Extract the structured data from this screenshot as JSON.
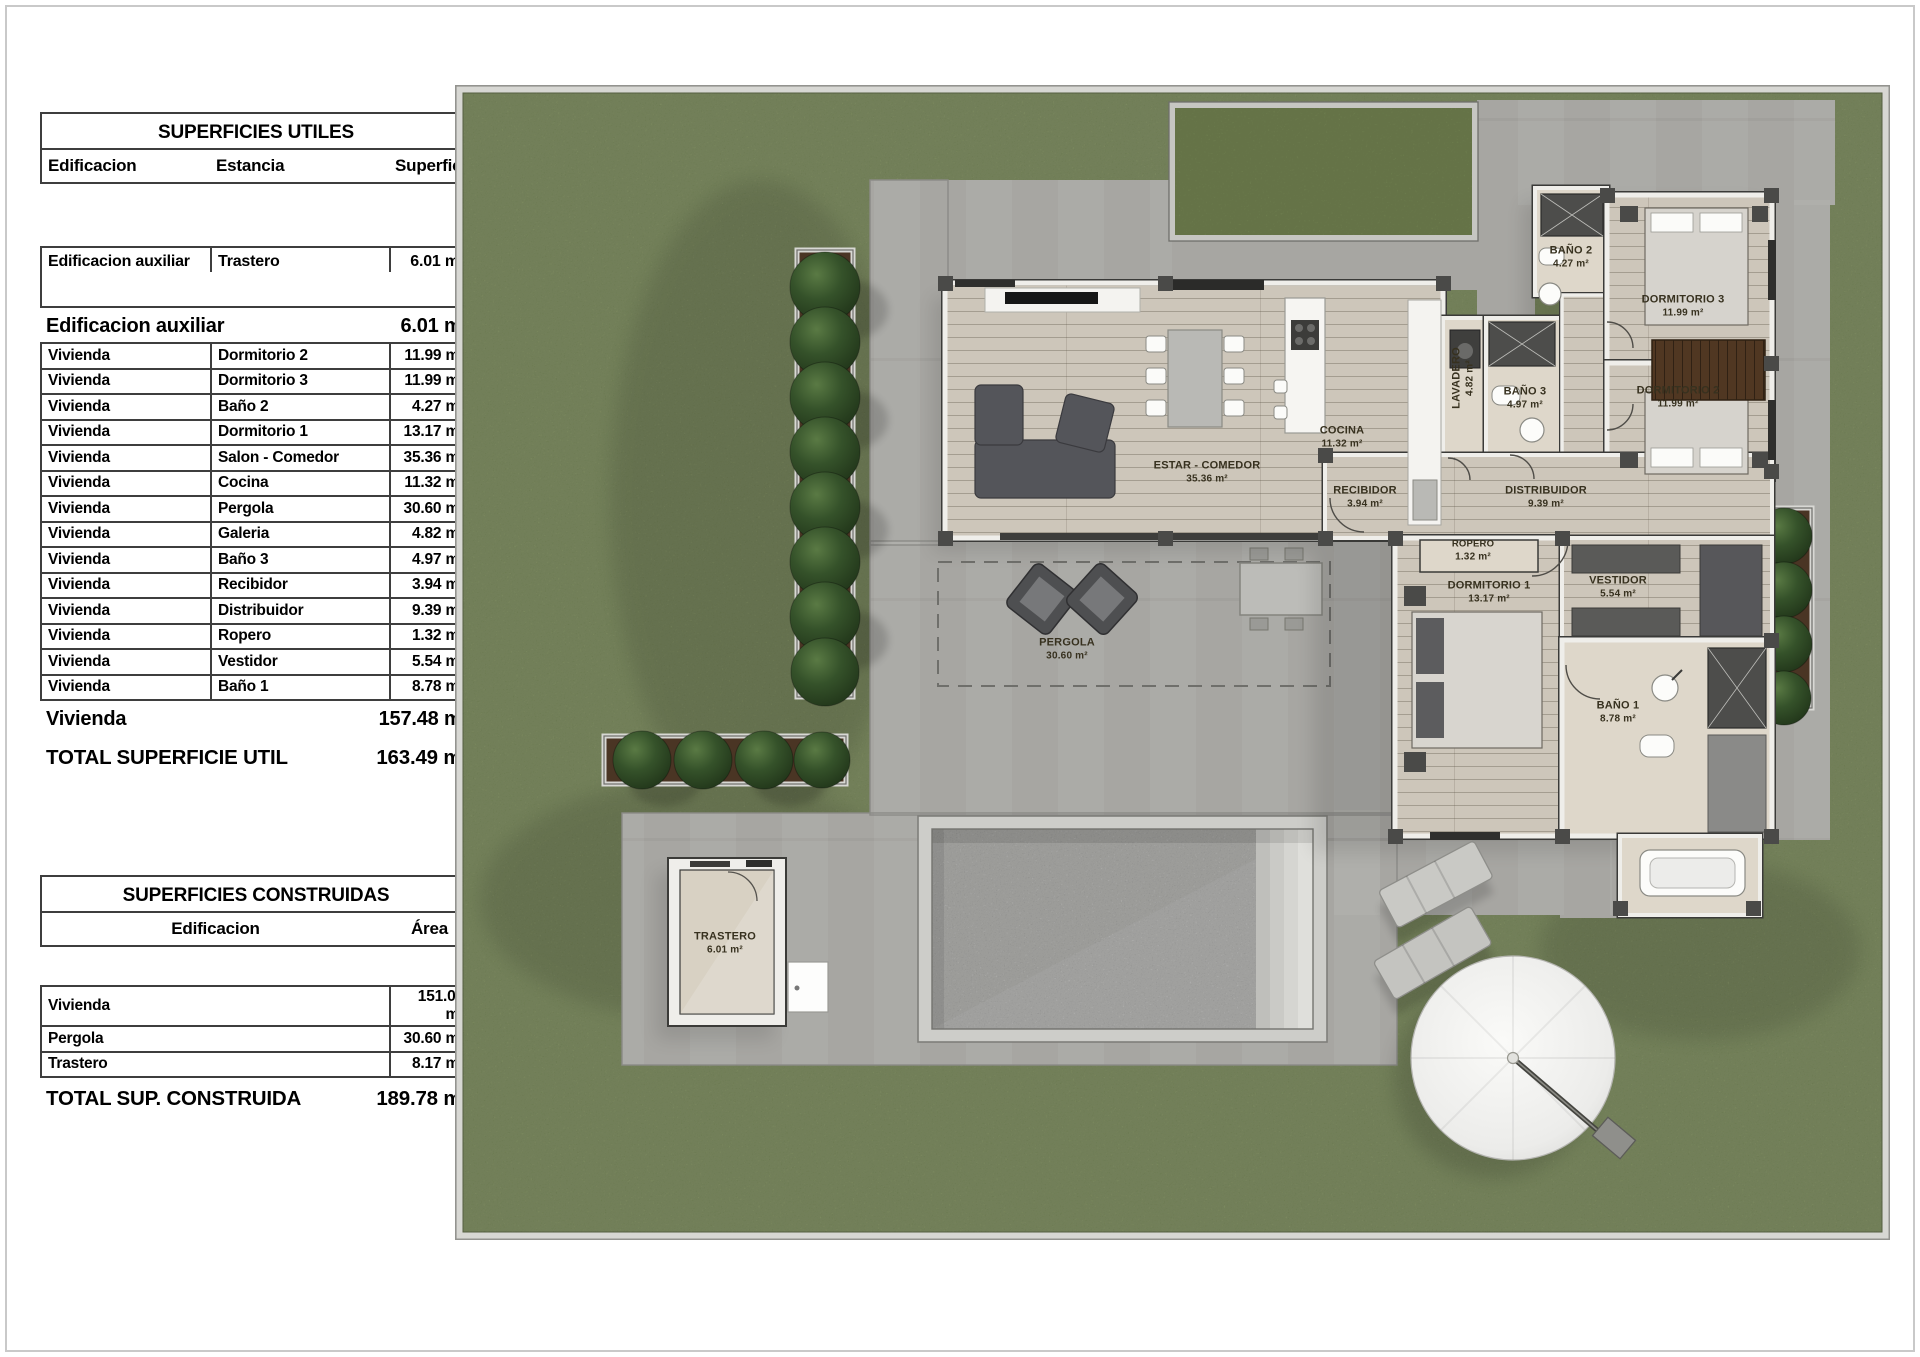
{
  "tables": {
    "superficies_utiles": {
      "title": "SUPERFICIES UTILES",
      "columns": [
        "Edificacion",
        "Estancia",
        "Superficie"
      ],
      "aux_row": {
        "edificacion": "Edificacion auxiliar",
        "estancia": "Trastero",
        "superficie": "6.01 m²"
      },
      "aux_total": {
        "label": "Edificacion auxiliar",
        "value": "6.01 m²"
      },
      "rows": [
        {
          "edificacion": "Vivienda",
          "estancia": "Dormitorio 2",
          "superficie": "11.99 m²"
        },
        {
          "edificacion": "Vivienda",
          "estancia": "Dormitorio 3",
          "superficie": "11.99 m²"
        },
        {
          "edificacion": "Vivienda",
          "estancia": "Baño 2",
          "superficie": "4.27 m²"
        },
        {
          "edificacion": "Vivienda",
          "estancia": "Dormitorio 1",
          "superficie": "13.17 m²"
        },
        {
          "edificacion": "Vivienda",
          "estancia": "Salon - Comedor",
          "superficie": "35.36 m²"
        },
        {
          "edificacion": "Vivienda",
          "estancia": "Cocina",
          "superficie": "11.32 m²"
        },
        {
          "edificacion": "Vivienda",
          "estancia": "Pergola",
          "superficie": "30.60 m²"
        },
        {
          "edificacion": "Vivienda",
          "estancia": "Galeria",
          "superficie": "4.82 m²"
        },
        {
          "edificacion": "Vivienda",
          "estancia": "Baño 3",
          "superficie": "4.97 m²"
        },
        {
          "edificacion": "Vivienda",
          "estancia": "Recibidor",
          "superficie": "3.94 m²"
        },
        {
          "edificacion": "Vivienda",
          "estancia": "Distribuidor",
          "superficie": "9.39 m²"
        },
        {
          "edificacion": "Vivienda",
          "estancia": "Ropero",
          "superficie": "1.32 m²"
        },
        {
          "edificacion": "Vivienda",
          "estancia": "Vestidor",
          "superficie": "5.54 m²"
        },
        {
          "edificacion": "Vivienda",
          "estancia": "Baño 1",
          "superficie": "8.78 m²"
        }
      ],
      "vivienda_total": {
        "label": "Vivienda",
        "value": "157.48 m²"
      },
      "total": {
        "label": "TOTAL SUPERFICIE UTIL",
        "value": "163.49 m²"
      }
    },
    "superficies_construidas": {
      "title": "SUPERFICIES CONSTRUIDAS",
      "columns": [
        "Edificacion",
        "Área"
      ],
      "rows": [
        {
          "edificacion": "Vivienda",
          "area": "151.00 m²"
        },
        {
          "edificacion": "Pergola",
          "area": "30.60 m²"
        },
        {
          "edificacion": "Trastero",
          "area": "8.17 m²"
        }
      ],
      "total": {
        "label": "TOTAL SUP. CONSTRUIDA",
        "value": "189.78 m²"
      }
    }
  },
  "plan": {
    "rooms": [
      {
        "id": "estar",
        "label": "ESTAR - COMEDOR",
        "area": "35.36 m²"
      },
      {
        "id": "cocina",
        "label": "COCINA",
        "area": "11.32 m²"
      },
      {
        "id": "lavadero",
        "label": "LAVADERO",
        "area": "4.82 m²",
        "vertical": true
      },
      {
        "id": "bano3",
        "label": "BAÑO 3",
        "area": "4.97 m²"
      },
      {
        "id": "bano2",
        "label": "BAÑO 2",
        "area": "4.27 m²"
      },
      {
        "id": "dorm3",
        "label": "DORMITORIO 3",
        "area": "11.99 m²"
      },
      {
        "id": "dorm2",
        "label": "DORMITORIO 2",
        "area": "11.99 m²"
      },
      {
        "id": "recibidor",
        "label": "RECIBIDOR",
        "area": "3.94 m²"
      },
      {
        "id": "distribuidor",
        "label": "DISTRIBUIDOR",
        "area": "9.39 m²"
      },
      {
        "id": "ropero",
        "label": "ROPERO",
        "area": "1.32 m²",
        "small": true
      },
      {
        "id": "dorm1",
        "label": "DORMITORIO 1",
        "area": "13.17 m²"
      },
      {
        "id": "vestidor",
        "label": "VESTIDOR",
        "area": "5.54 m²"
      },
      {
        "id": "bano1",
        "label": "BAÑO 1",
        "area": "8.78 m²"
      },
      {
        "id": "pergola",
        "label": "PERGOLA",
        "area": "30.60 m²"
      },
      {
        "id": "trastero",
        "label": "TRASTERO",
        "area": "6.01 m²"
      }
    ],
    "colors": {
      "lawn": "#7c8e58",
      "patio": "#a7a6a2",
      "pool": "#b3b3af",
      "wood": "#cdc6ba",
      "tile": "#ded7ca",
      "wall": "#efeeea",
      "tree": "#2f4b24",
      "planter": "#4a3524"
    }
  }
}
